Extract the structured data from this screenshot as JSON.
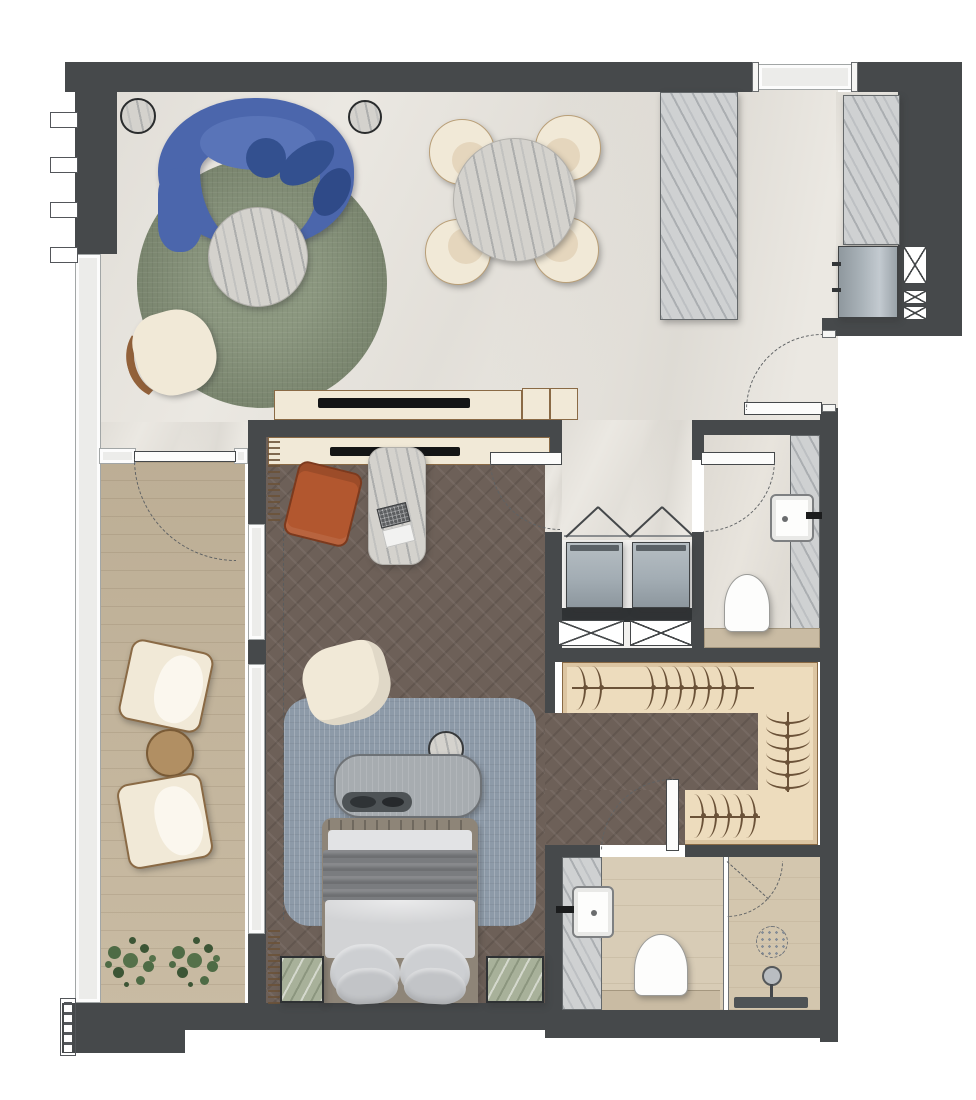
{
  "meta": {
    "title": "Apartment floor plan",
    "type": "architectural-floor-plan",
    "canvas": {
      "width": 976,
      "height": 1100
    }
  },
  "palette": {
    "white": "#ffffff",
    "wall": "#46494b",
    "wallEdge": "#303335",
    "marble": "#ebe8e2",
    "herr": "#6d6058",
    "wood": "#c4b59b",
    "wardrobe": "#eddcbd",
    "wardrobeLine": "#8a6a45",
    "hanger": "#6b5238",
    "bathTile": "#d8ccb6",
    "bathShower": "#d3c6ae",
    "bathLedge": "#c9bba3",
    "wcFloor": "#e8e4dd",
    "laundry": "#f2f1ef",
    "glass": "#ececea",
    "glassFrame": "#a2a6a6",
    "doorLine": "#45484a",
    "arcCol": "#5f6264",
    "sofa": "#4b66ac",
    "sofaDark": "#33508f",
    "sofaSeat": "#5974b8",
    "rugGreen": "#7e8b71",
    "rugBlue": "#8d9aa8",
    "cream": "#f1e9d7",
    "creamIn": "#e5d6bd",
    "woodTrim": "#92613a",
    "rust": "#b2572f",
    "rustDark": "#7c3a1e",
    "stone": "#cfd1d2",
    "bedFrame": "#8e8578",
    "sheet": "#e2e3e5",
    "throwG": "#7a7c7f",
    "duvet": "#d2d3d5",
    "pillow": "#cdcfd2",
    "pillowD": "#c2c4c7",
    "benchG": "#a7acb0",
    "trayD": "#4e5356",
    "night": "#a8b19a",
    "washer": "#a3adb4",
    "appliance": "#aab3b9",
    "plant1": "#4e6b45",
    "plant2": "#3c5535",
    "plant3": "#55714a",
    "tanTable": "#b18f63",
    "tanLine": "#7a5b36",
    "kb": "#6f7173"
  },
  "rooms": [
    "living-room",
    "dining-area",
    "kitchen-niche",
    "entry-foyer",
    "balcony",
    "bedroom",
    "laundry-closet",
    "powder-room",
    "walk-in-closet",
    "bathroom"
  ],
  "furniture": [
    "curved-sofa",
    "living-round-rug",
    "coffee-table",
    "living-armchair",
    "mirror-side-table-1",
    "mirror-side-table-2",
    "dining-table",
    "dining-chair-x4",
    "marble-column",
    "kitchen-counter",
    "appliance-cabinet",
    "tv-console-living",
    "tv-console-bedroom",
    "writing-desk",
    "laptop",
    "accent-armchair",
    "occasional-chair",
    "bedroom-rug",
    "foot-bench",
    "bench-tray",
    "pouf",
    "double-bed",
    "nightstand-left",
    "nightstand-right",
    "lounge-chair-1",
    "lounge-chair-2",
    "balcony-side-table",
    "planter-1",
    "planter-2",
    "washer",
    "dryer",
    "wc-toilet",
    "wc-sink",
    "bath-toilet",
    "bath-sink",
    "shower-head",
    "floor-drain",
    "shower-bench",
    "wardrobe-hangers"
  ],
  "doors": [
    "entry-door",
    "bedroom-door",
    "wc-door",
    "closet-bath-door",
    "balcony-door",
    "shower-door",
    "laundry-bifold-doors"
  ],
  "windows": [
    "west-facade-glazing",
    "top-wall-window",
    "bedroom-balcony-glazing",
    "balcony-south-glazing"
  ],
  "symbols": [
    "door-swing-arc",
    "shaft-x-box",
    "curtain-coil",
    "hanger-icon",
    "plant-icon"
  ]
}
